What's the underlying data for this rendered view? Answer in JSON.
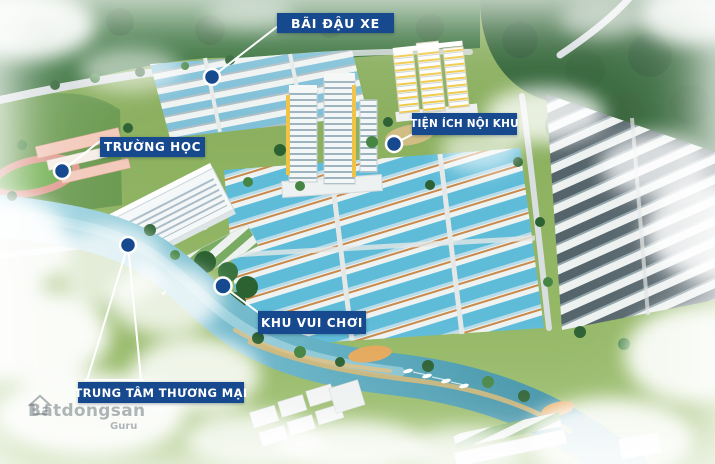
{
  "project_map": {
    "description": "Aerial 3D master-plan rendering of a residential development with amenity callouts",
    "callouts": [
      {
        "id": "parking-lot",
        "label": "BÃI ĐẬU XE"
      },
      {
        "id": "internal-amenities",
        "label": "TIỆN ÍCH NỘI KHU"
      },
      {
        "id": "school",
        "label": "TRƯỜNG HỌC"
      },
      {
        "id": "playground",
        "label": "KHU VUI CHƠI"
      },
      {
        "id": "shopping-mall",
        "label": "TRUNG TÂM THƯƠNG MẠI"
      }
    ]
  },
  "watermark": {
    "domain_suffix": "com.vn",
    "brand": "Batdongsan",
    "tagline": "Guru"
  },
  "colors": {
    "callout_background": "#17498E",
    "callout_text": "#FFFFFF",
    "marker_fill": "#17498E",
    "marker_ring": "#FFFFFF",
    "connector_line": "#FFFFFF",
    "river": "#3E8FA3",
    "roof_glass": "#5FBCD9",
    "forest": "#2E6233"
  }
}
